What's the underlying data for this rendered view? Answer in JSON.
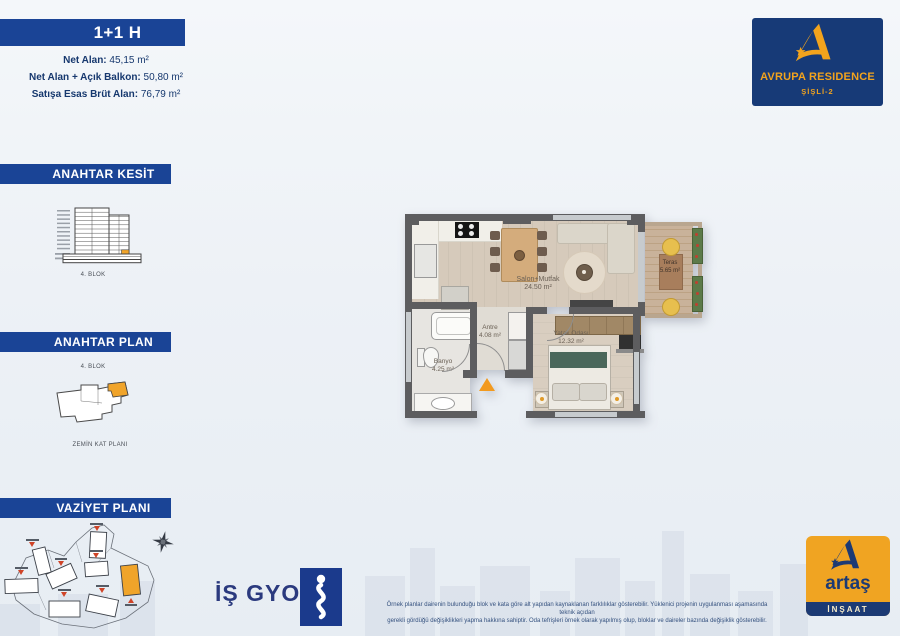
{
  "title": {
    "unit": "1+1 H"
  },
  "areas": {
    "net": {
      "label": "Net Alan:",
      "value": " 45,15 m²"
    },
    "balkon": {
      "label": "Net Alan + Açık Balkon:",
      "value": " 50,80 m²"
    },
    "brut": {
      "label": "Satışa Esas Brüt Alan:",
      "value": " 76,79 m²"
    }
  },
  "sections": {
    "kesit": {
      "title": "ANAHTAR KESİT",
      "caption": "4. BLOK"
    },
    "plan": {
      "title": "ANAHTAR PLAN",
      "block": "4. BLOK",
      "caption": "ZEMİN KAT PLANI"
    },
    "vaziyet": {
      "title": "VAZİYET PLANI"
    }
  },
  "floorplan": {
    "salon": {
      "name": "Salon+Mutfak",
      "area": "24.50 m²"
    },
    "yatak": {
      "name": "Yatak Odası",
      "area": "12.32 m²"
    },
    "antre": {
      "name": "Antre",
      "area": "4.08 m²"
    },
    "banyo": {
      "name": "Banyo",
      "area": "4.25 m²"
    },
    "teras": {
      "name": "Teras",
      "area": "5.65 m²"
    }
  },
  "logos": {
    "avrupa": {
      "line1": "AVRUPA RESIDENCE",
      "line2": "ŞİŞLİ-2"
    },
    "isgyo": {
      "text": "İŞ GYO"
    },
    "artas": {
      "name": "artaş",
      "sub": "İNŞAAT"
    }
  },
  "disclaimer": {
    "line1": "Örnek planlar dairenin bulunduğu blok ve kata göre alt yapıdan kaynaklanan farklılıklar gösterebilir. Yüklenici projenin uygulanması aşamasında teknik açıdan",
    "line2": "gerekli gördüğü değişiklikleri yapma hakkına sahiptir. Oda tefrişleri örnek olarak yapılmış olup, bloklar ve daireler bazında değişiklik gösterebilir."
  },
  "colors": {
    "bar_navy": "#1a4496",
    "text_navy": "#16386e",
    "logo_navy": "#173a77",
    "accent_orange": "#f2a31d",
    "wall_gray": "#5d5d5f",
    "highlight_unit": "#f0a42a"
  }
}
